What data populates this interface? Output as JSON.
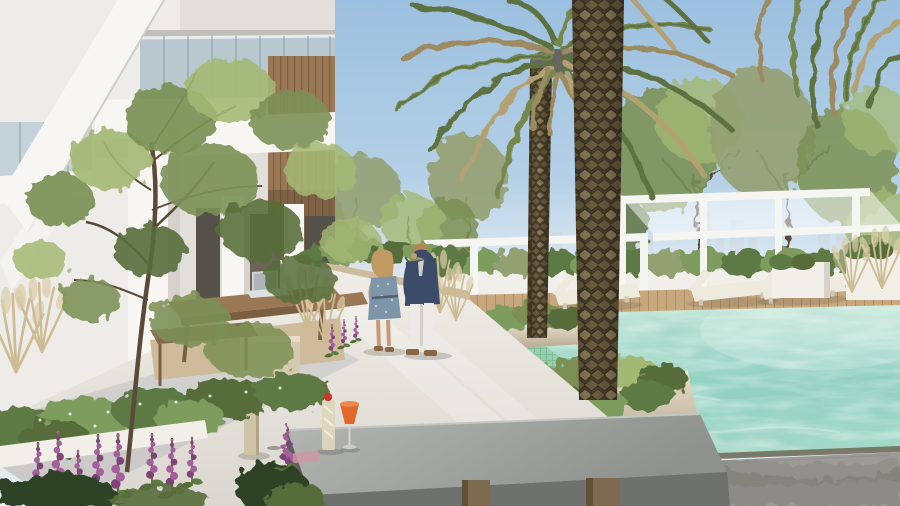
{
  "meta": {
    "type": "architectural-render",
    "scene": "Architectural rendering: rooftop swimming-pool courtyard of a white residential building on a sunny day, with two date palms, white pergolas with sun loungers, a couple talking on a light concrete walkway, lush planting with purple foxgloves, and a concrete bench with two cocktails in the foreground against a hazy city skyline.",
    "width": 900,
    "height": 506
  },
  "scene": {
    "objects": [
      {
        "name": "residential-building",
        "desc": "white modern apartment building with balconies and diagonal brace"
      },
      {
        "name": "balcony-glass-railing",
        "desc": "blue-tinted glass balustrade panels"
      },
      {
        "name": "timber-cladding",
        "desc": "vertical warm wood wall panel"
      },
      {
        "name": "courtyard-tree",
        "desc": "slender multi-branch tree in front of facade"
      },
      {
        "name": "outdoor-work-table",
        "desc": "timber table with open laptop"
      },
      {
        "name": "laptop",
        "desc": "silver laptop on table"
      },
      {
        "name": "path-light-bollard",
        "desc": "beige bollard light"
      },
      {
        "name": "landscaped-bed",
        "desc": "hedges, gravel, grasses and purple foxgloves"
      },
      {
        "name": "walkway",
        "desc": "light concrete pool-side path"
      },
      {
        "name": "woman-in-dress",
        "desc": "blonde woman in blue patterned dress"
      },
      {
        "name": "man-in-blazer",
        "desc": "man in navy blazer and white trousers"
      },
      {
        "name": "swimming-pool",
        "desc": "turquoise pool with tiled shallow shelf"
      },
      {
        "name": "stepping-platforms",
        "desc": "white slabs crossing the water"
      },
      {
        "name": "pool-planter-islands",
        "desc": "planted islands holding the palms"
      },
      {
        "name": "date-palm-front",
        "desc": "large diamond-cut palm trunk, full height"
      },
      {
        "name": "date-palm-rear",
        "desc": "palm with green and dried drooping fronds"
      },
      {
        "name": "pergolas",
        "desc": "white steel pergola frames"
      },
      {
        "name": "sun-loungers",
        "desc": "white chaise lounges on timber deck"
      },
      {
        "name": "city-skyline",
        "desc": "hazy high-rise skyline on horizon"
      },
      {
        "name": "concrete-bench",
        "desc": "grey cantilevered bench with bronze legs"
      },
      {
        "name": "cocktails",
        "desc": "iced glass and orange spritz"
      },
      {
        "name": "stone-paving",
        "desc": "grey pavers with tree shadows"
      }
    ]
  },
  "palette": {
    "sky_top": "#9cc0df",
    "sky_mid": "#c3d9ea",
    "sky_horizon": "#e9eef0",
    "skyline": "#b9c4ce",
    "water_far": "#c6e8db",
    "water_mid": "#93d2c1",
    "water_near": "#a9dcca",
    "lane": "#98cfa9",
    "lane_grid": "#7ab892",
    "drain": "#6e675a",
    "curb": "#e8e5df",
    "walkway": "#e9e6e0",
    "walk_shadow": "#9aa0ad",
    "bldg": "#eeece8",
    "bldg_bright": "#f7f6f3",
    "bldg_shadow": "#d6d2cb",
    "bldg_dark": "#c2beb7",
    "recess": "#575249",
    "glass": "#b7c9d4",
    "glass_frame": "#8fa3ae",
    "wood": "#9a7855",
    "wood_dark": "#7c5f40",
    "deck": "#c7a87e",
    "deck_line": "#b08f64",
    "pergola": "#f5f5f2",
    "lounger": "#efeade",
    "planter": "#cdbb9c",
    "planter_bright": "#f2efe8",
    "island_top": "#e6ddca",
    "island_bot": "#b3a78e",
    "gravel": "#b49f7e",
    "stone": "#9b9a94",
    "stone_shadow": "#4a4a42",
    "bench_top": "#a9aba8",
    "bench_front": "#6e716e",
    "bench_leg": "#7d6a4f",
    "trunk": "#6b5c3f",
    "trunk_dark": "#4a3f2a",
    "trunk_light": "#8a7a58",
    "frond_green": "#74874d",
    "frond_green2": "#5d7240",
    "frond_dry": "#b3a173",
    "frond_dry2": "#9c8a60",
    "leaf": "#7b9054",
    "leaf_light": "#a3b873",
    "leaf_dark": "#566d3a",
    "olive": "#93a071",
    "hedge": "#5d7a44",
    "hedge_light": "#7f9c5e",
    "foliage_dark": "#2f4226",
    "grass_tan": "#cdbb94",
    "grass_tip": "#dccda8",
    "purple": "#a55f9c",
    "purple_dark": "#7f4377",
    "skin": "#c79a7a",
    "hair_blonde": "#c09a63",
    "hair_brown": "#b08a52",
    "navy": "#3c4c68",
    "dress": "#7e94a8",
    "dress_dot": "#c6d2da",
    "white_cloth": "#eceae6",
    "shoe": "#8a6742",
    "spritz": "#e0662a",
    "glass_cream": "#ded5bd",
    "napkin": "#cf96a4",
    "bollard": "#cfc3a8",
    "railing": "#3f3e38",
    "branch": "#5a4a38"
  }
}
